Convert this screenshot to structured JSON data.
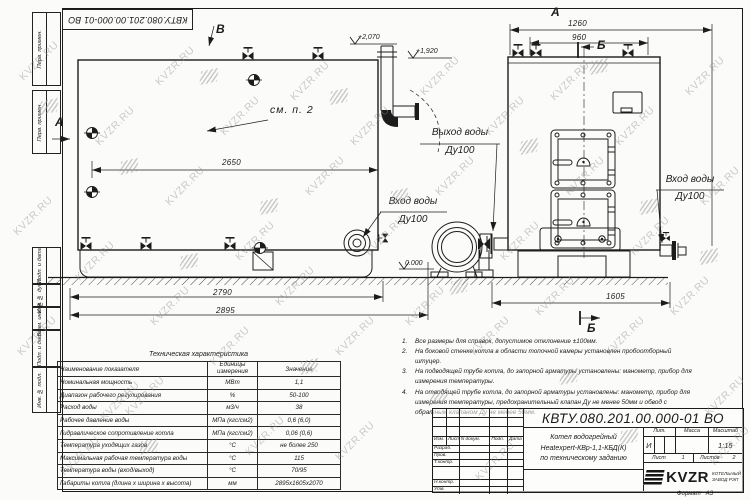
{
  "watermark": {
    "text": "KVZR.RU"
  },
  "corner_stamp": {
    "number": "КВТУ.080.201.00.000-01 ВО"
  },
  "margin_blocks": {
    "b1": "Перв. примен.",
    "b2": "Перв. примен.",
    "b3": "Подп. и дата",
    "b4": "Инв. № дубл.",
    "b5": "Взам. инв. №",
    "b6": "Подп. и дата",
    "b7": "Инв. № подл."
  },
  "views": {
    "marker_v": "В",
    "marker_a_side": "А",
    "marker_a_top": "А",
    "marker_b_top": "Б",
    "marker_b_bottom": "Б",
    "see_note": "см. п. 2",
    "water_outlet": {
      "line1": "Выход воды",
      "line2": "Ду100"
    },
    "water_inlet_center": {
      "line1": "Вход воды",
      "line2": "Ду100"
    },
    "water_inlet_right": {
      "line1": "Вход воды",
      "line2": "Ду100"
    },
    "elev_plus2070": "+2,070",
    "elev_plus1920": "+1,920",
    "elev_zero": "0.000",
    "dim_2650": "2650",
    "dim_2790": "2790",
    "dim_2895": "2895",
    "dim_1260": "1260",
    "dim_960": "960",
    "dim_1605": "1605"
  },
  "table": {
    "title": "Техническая характеристика",
    "col1": "Наименование показателя",
    "col2": "Единицы измерения",
    "col3": "Значение",
    "rows": [
      [
        "Номинальная мощность",
        "МВт",
        "1,1"
      ],
      [
        "Диапазон рабочего регулирования",
        "%",
        "50-100"
      ],
      [
        "Расход воды",
        "м3/ч",
        "38"
      ],
      [
        "Рабочее давление воды",
        "МПа (кгс/см2)",
        "0,6 (6,0)"
      ],
      [
        "Гидравлическое сопротивление котла",
        "МПа (кгс/см2)",
        "0,06 (0,6)"
      ],
      [
        "Температура уходящих газов",
        "°С",
        "не более 250"
      ],
      [
        "Максимальная рабочая температура воды",
        "°С",
        "115"
      ],
      [
        "Температура воды (вход/выход)",
        "°С",
        "70/95"
      ],
      [
        "Габариты котла (длина х ширина х высота)",
        "мм",
        "2895х1605х2070"
      ]
    ]
  },
  "notes": [
    {
      "num": "1.",
      "text": "Все размеры для справок, допустимое отклонение ±100мм."
    },
    {
      "num": "2.",
      "text": "На боковой стенке котла в области топочной камеры установлен пробоотборный штуцер."
    },
    {
      "num": "3.",
      "text": "На подводящей трубе котла, до запорной арматуры установлены: манометр, прибор для измерения температуры."
    },
    {
      "num": "4.",
      "text": "На отводящей трубе котла, до запорной арматуры установлены: манометр, прибор для измерения температуры, предохранительный клапан Ду не менее 50мм и обвод с обратным клапаном Ду не менее 50мм."
    }
  ],
  "title_block": {
    "doc_number": "КВТУ.080.201.00.000-01 ВО",
    "cols": {
      "izm": "Изм.",
      "list": "Лист",
      "ndoc": "N докум.",
      "podp": "Подп.",
      "data": "Дата"
    },
    "rows": {
      "r1": "Разраб.",
      "r2": "Пров.",
      "r3": "Т.контр.",
      "r4": "",
      "r5": "Н.контр.",
      "r6": "Утв."
    },
    "name_line1": "Котел водогрейный",
    "name_line2": "Heatexpert-КВр-1,1-КБД(К)",
    "name_line3": "по техническому заданию",
    "lit_label": "Лит.",
    "lit_value": "И",
    "mass_label": "Масса",
    "scale_label": "Масштаб",
    "scale_value": "1:15",
    "sheet_label": "Лист",
    "sheet_value": "1",
    "sheets_label": "Листов",
    "sheets_value": "2",
    "logo_text": "KVZR",
    "company_line1": "КОТЕЛЬНЫЙ",
    "company_line2": "ЗАВОД РЭП",
    "format_label": "Формат",
    "format_value": "А3"
  }
}
